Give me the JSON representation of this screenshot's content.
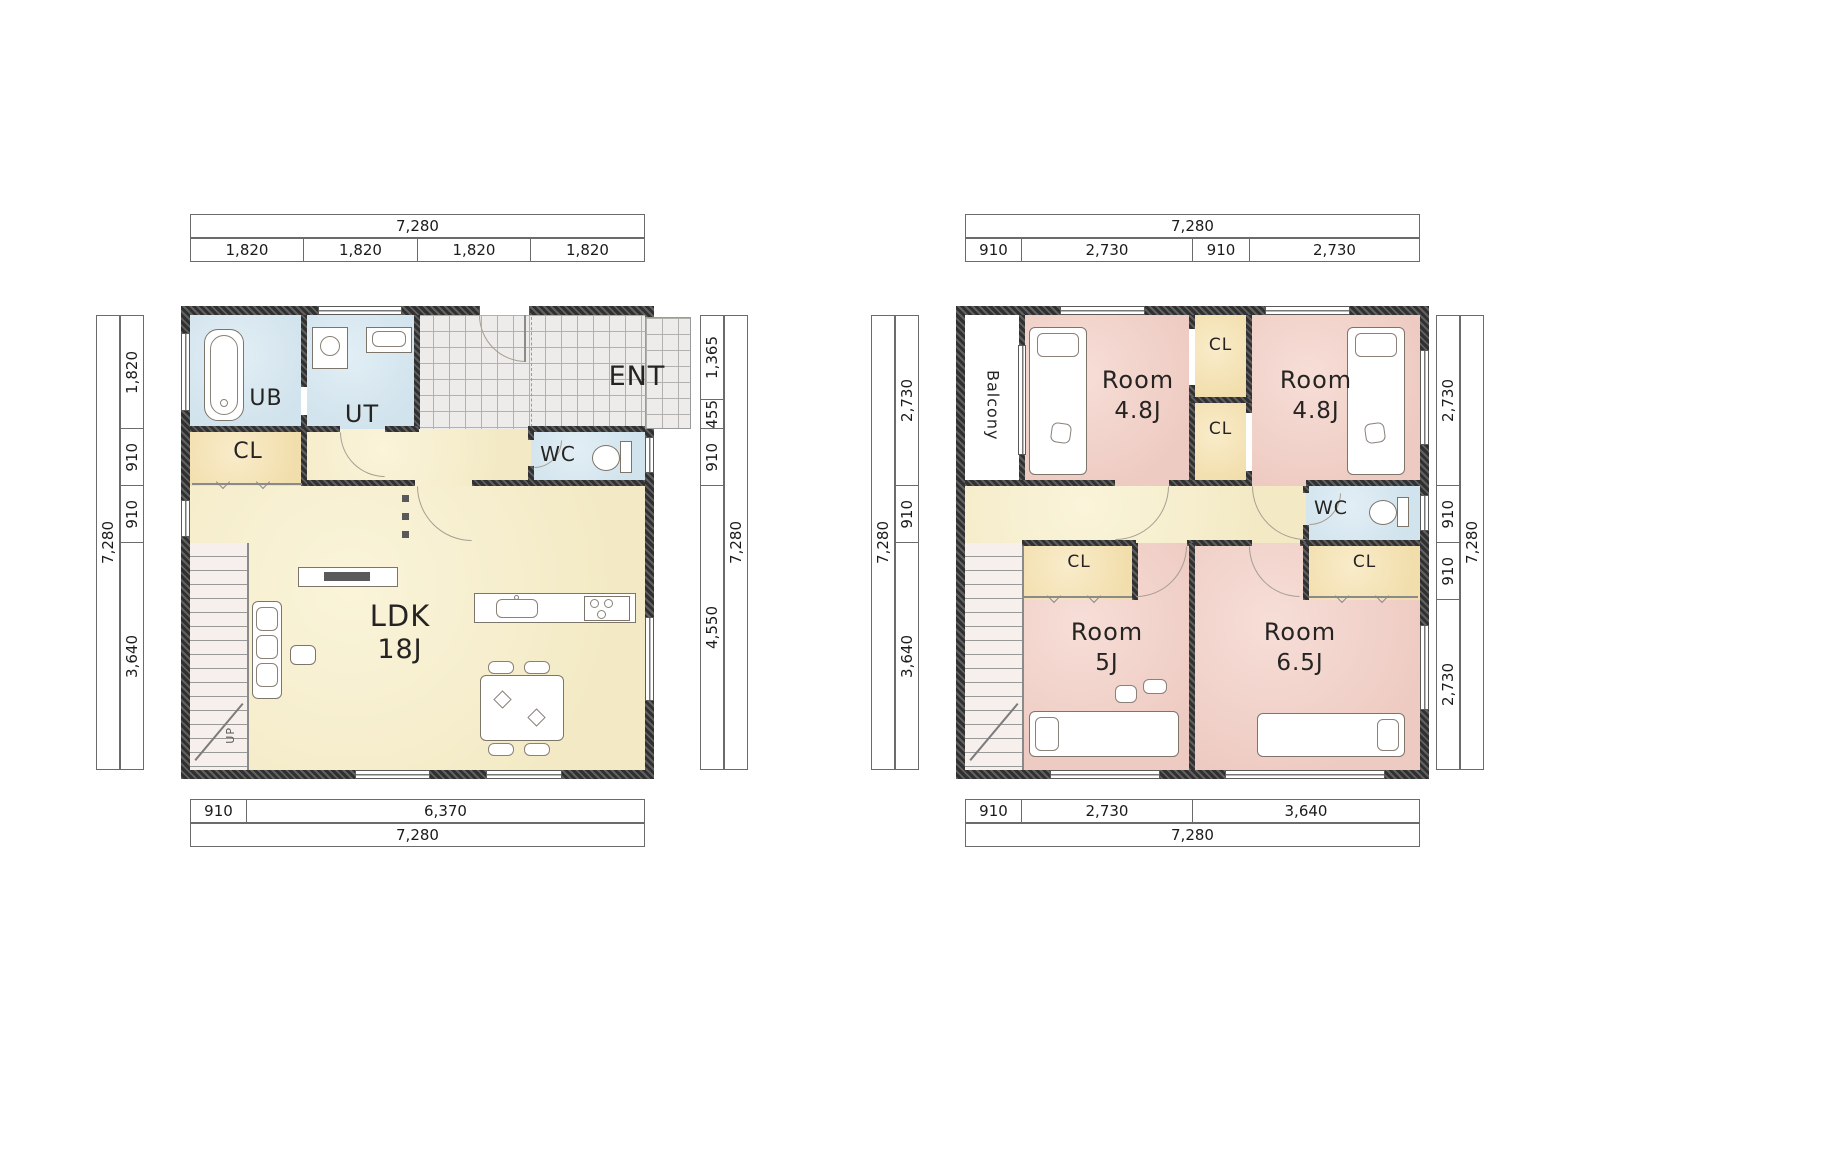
{
  "palette": {
    "wall_dark": "#313131",
    "ldk_yellow": "#f3eac5",
    "room_pink": "#eecbc2",
    "wet_area_blue": "#d1e3ed",
    "closet_cream": "#f2deac",
    "tile_gray": "#edecea"
  },
  "plans": {
    "floor1": {
      "dims": {
        "top_total": "7,280",
        "top_segments": [
          "1,820",
          "1,820",
          "1,820",
          "1,820"
        ],
        "left_total": "7,280",
        "left_segments": [
          "1,820",
          "910",
          "910",
          "3,640"
        ],
        "right_segments": [
          "1,365",
          "455",
          "910",
          "4,550"
        ],
        "right_total": "7,280",
        "bottom_segments": [
          "910",
          "6,370"
        ],
        "bottom_total": "7,280"
      },
      "labels": {
        "ub": "UB",
        "ut": "UT",
        "ent": "ENT",
        "cl": "CL",
        "wc": "WC",
        "ldk": "LDK",
        "ldk_size": "18J",
        "up": "UP"
      }
    },
    "floor2": {
      "dims": {
        "top_total": "7,280",
        "top_segments": [
          "910",
          "2,730",
          "910",
          "2,730"
        ],
        "left_total": "7,280",
        "left_segments": [
          "2,730",
          "910",
          "3,640"
        ],
        "right_segments": [
          "2,730",
          "910",
          "910",
          "2,730"
        ],
        "right_total": "7,280",
        "bottom_segments": [
          "910",
          "2,730",
          "3,640"
        ],
        "bottom_total": "7,280"
      },
      "labels": {
        "balcony": "Balcony",
        "room_a": "Room",
        "room_a_size": "4.8J",
        "cl_top": "CL",
        "cl_mid": "CL",
        "room_b": "Room",
        "room_b_size": "4.8J",
        "wc": "WC",
        "cl_left": "CL",
        "room_c": "Room",
        "room_c_size": "5J",
        "cl_right": "CL",
        "room_d": "Room",
        "room_d_size": "6.5J"
      }
    }
  }
}
